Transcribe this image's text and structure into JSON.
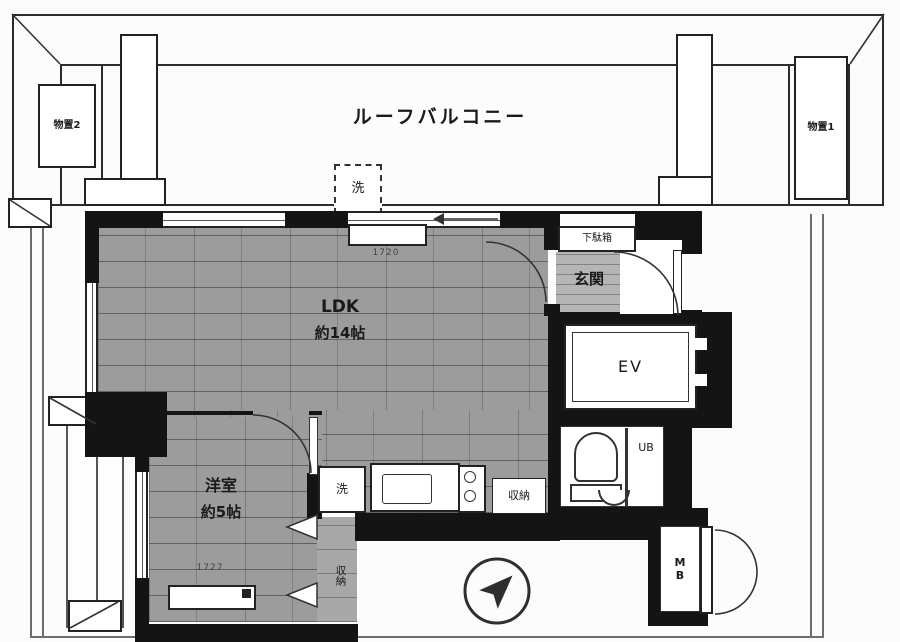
{
  "balcony": {
    "label": "ルーフバルコニー",
    "storage_left": "物置2",
    "storage_right": "物置1",
    "washer_pad": "洗"
  },
  "ldk": {
    "name": "LDK",
    "size": "約14帖"
  },
  "western_room": {
    "name": "洋室",
    "size": "約5帖"
  },
  "entrance": {
    "name": "玄関",
    "shoe_cabinet": "下駄箱"
  },
  "elevator": {
    "label": "EV"
  },
  "bath": {
    "unit_bath": "UB"
  },
  "kitchen": {
    "washer_pad": "洗",
    "storage": "収納"
  },
  "room_closet": {
    "label": "収納"
  },
  "meter_box": {
    "label": "MB"
  },
  "dimensions": {
    "ldk_width": "1720",
    "room_width": "1727"
  },
  "compass": {
    "icon": "north-east-arrow"
  },
  "colors": {
    "wall": "#141414",
    "wood_floor": "#9c9c9c",
    "tile_floor": "#b5b5b5",
    "outline": "#2c2c2c"
  }
}
